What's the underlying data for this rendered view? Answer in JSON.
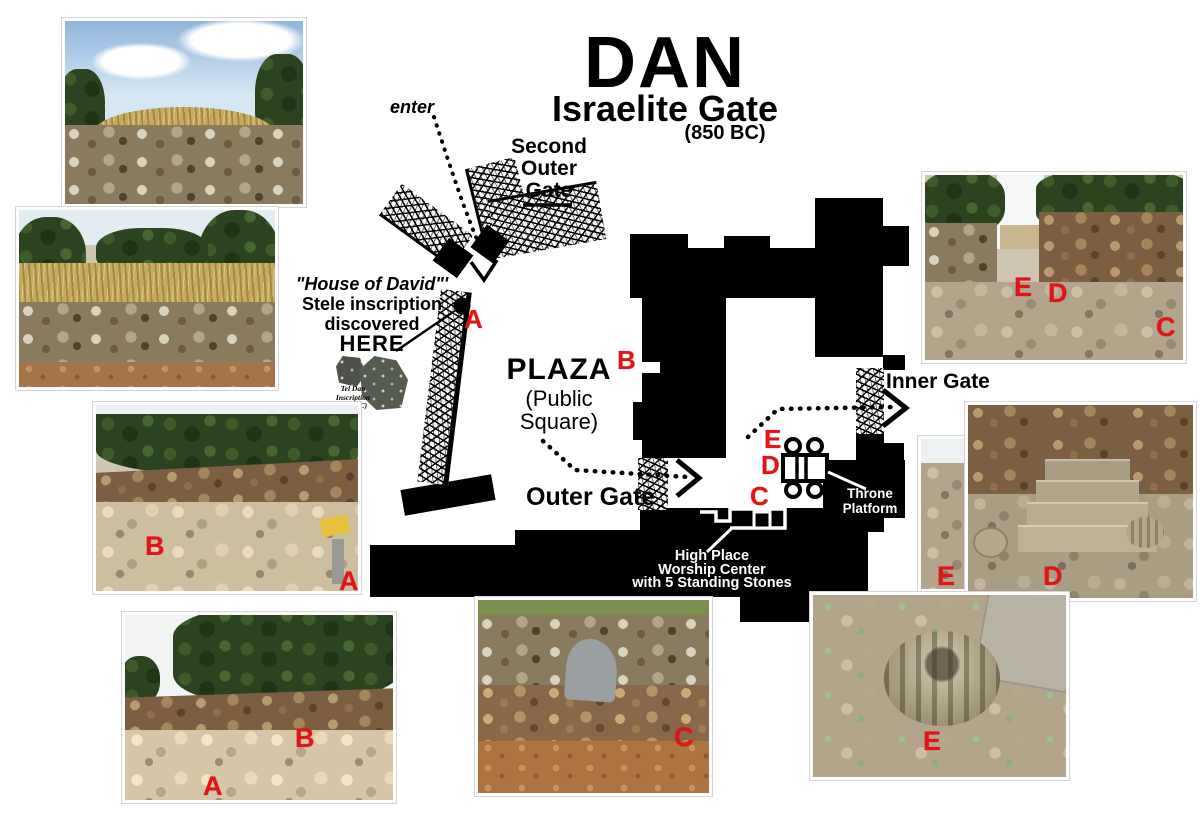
{
  "title": {
    "main": "DAN",
    "subtitle": "Israelite Gate",
    "date": "(850 BC)"
  },
  "map": {
    "enter_label": "enter",
    "second_outer_gate_lines": [
      "Second",
      "Outer",
      "Gate"
    ],
    "stele_note_lines": [
      "\"House of David\"'",
      "Stele inscription",
      "discovered",
      "HERE"
    ],
    "tel_dan_caption_lines": [
      "Tel Dan",
      "Inscription",
      "(841 BC)"
    ],
    "plaza_title": "PLAZA",
    "plaza_sub_lines": [
      "(Public",
      "Square)"
    ],
    "outer_gate_label": "Outer Gate",
    "inner_gate_label": "Inner Gate",
    "throne_platform_lines": [
      "Throne",
      "Platform"
    ],
    "high_place_lines": [
      "High Place",
      "Worship Center",
      "with 5 Standing Stones"
    ]
  },
  "letters": {
    "a": "A",
    "b": "B",
    "c": "C",
    "d": "D",
    "e": "E"
  },
  "colors": {
    "marker_red": "#e41414",
    "map_black": "#000000",
    "wall_texture_base": "#f6f6f6"
  }
}
